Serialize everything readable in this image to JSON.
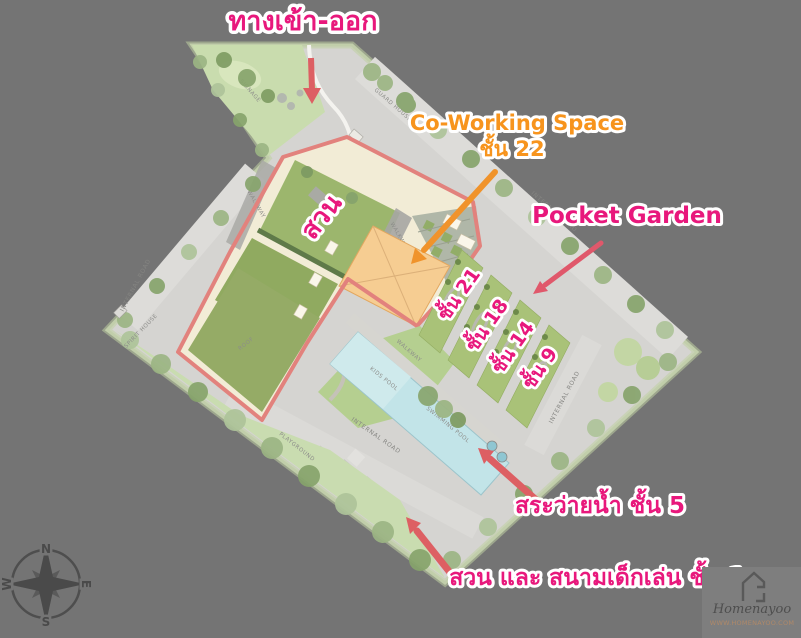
{
  "background_color": "#747474",
  "annotations": {
    "entrance": {
      "text": "ทางเข้า-ออก",
      "color": "#e8187c"
    },
    "coworking": {
      "line1": "Co-Working Space",
      "line2": "ชั้น 22",
      "color": "#f7941d"
    },
    "pocket_garden": {
      "text": "Pocket Garden",
      "color": "#e8187c"
    },
    "floors": {
      "f21": "ชั้น 21",
      "f18": "ชั้น 18",
      "f14": "ชั้น 14",
      "f9": "ชั้น 9"
    },
    "pool": {
      "text": "สระว่ายน้ำ ชั้น 5"
    },
    "garden_playground": {
      "text": "สวน และ สนามเด็กเล่น ชั้น 1"
    },
    "garden": {
      "text": "สวน"
    }
  },
  "plan_labels": {
    "internal_road": "INTERNAL ROAD",
    "walkway": "WALKWAY",
    "guard_house": "GUARD HOUSE",
    "spirit_house": "SPIRIT HOUSE",
    "signage": "SIGNAGE",
    "lawn": "LAWN",
    "kids_pool": "KIDS POOL",
    "swimming_pool": "SWIMMING POOL",
    "playground": "PLAYGROUND",
    "roof": "ROOF"
  },
  "compass": {
    "n": "N",
    "e": "E",
    "s": "S",
    "w": "W"
  },
  "watermark": {
    "brand": "Homenayoo",
    "url": "WWW.HOMENAYOO.COM"
  },
  "colors": {
    "pink_accent": "#e8187c",
    "orange_accent": "#f7941d",
    "arrow_red": "#dd5f63",
    "arrow_orange": "#f0932b",
    "site_outline_red": "#e2827d",
    "road_gray": "#d5d4d1",
    "building_cream": "#f2ecd6",
    "coworking_orange": "#f6cd92",
    "pool_blue": "#c2e4e8",
    "grass_green": "#9cb66d"
  }
}
